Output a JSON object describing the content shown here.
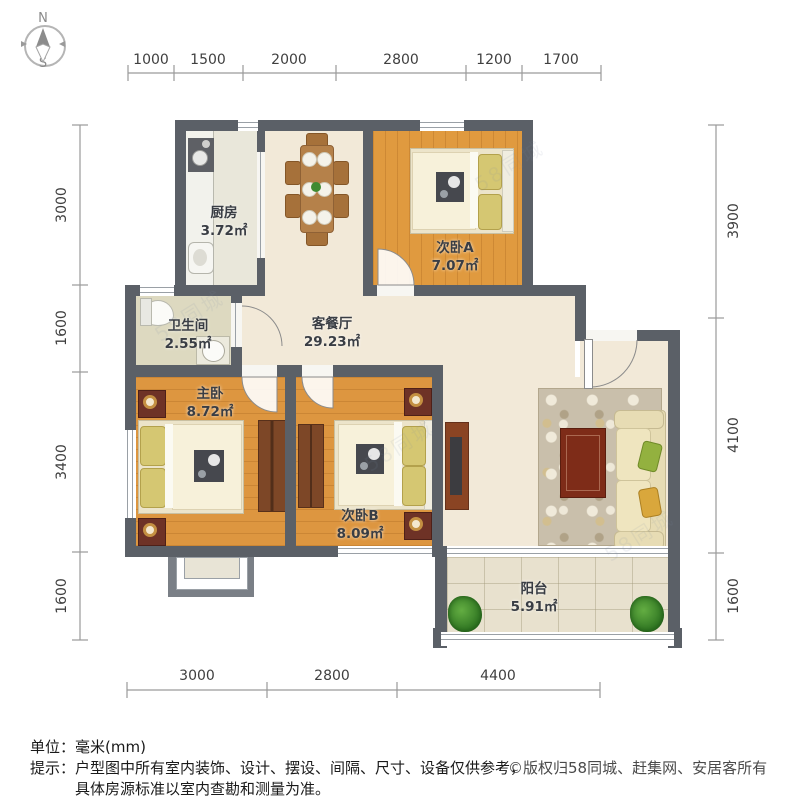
{
  "compass": {
    "north": "N",
    "south": "S"
  },
  "dimensions": {
    "top": [
      "1000",
      "1500",
      "2000",
      "2800",
      "1200",
      "1700"
    ],
    "bottom": [
      "3000",
      "2800",
      "4400"
    ],
    "left": [
      "3000",
      "1600",
      "3400",
      "1600"
    ],
    "right": [
      "3900",
      "4100",
      "1600"
    ]
  },
  "rooms": {
    "kitchen": {
      "name": "厨房",
      "area": "3.72㎡"
    },
    "bedroomA": {
      "name": "次卧A",
      "area": "7.07㎡"
    },
    "bathroom": {
      "name": "卫生间",
      "area": "2.55㎡"
    },
    "living": {
      "name": "客餐厅",
      "area": "29.23㎡"
    },
    "master": {
      "name": "主卧",
      "area": "8.72㎡"
    },
    "bedroomB": {
      "name": "次卧B",
      "area": "8.09㎡"
    },
    "balcony": {
      "name": "阳台",
      "area": "5.91㎡"
    }
  },
  "footer": {
    "unit": "单位：毫米(mm)",
    "tip_label": "提示：",
    "tip_line1": "户型图中所有室内装饰、设计、摆设、间隔、尺寸、设备仅供参考，",
    "tip_line2": "具体房源标准以室内查勘和测量为准。",
    "copyright": "©版权归58同城、赶集网、安居客所有"
  },
  "watermark": "58同城",
  "colors": {
    "wall": "#5b6067",
    "floor_beige": "#f2e9d8",
    "floor_wood": "#dd9640",
    "plant_green": "#2f7522",
    "sofa_cream": "#ebdfb6"
  }
}
